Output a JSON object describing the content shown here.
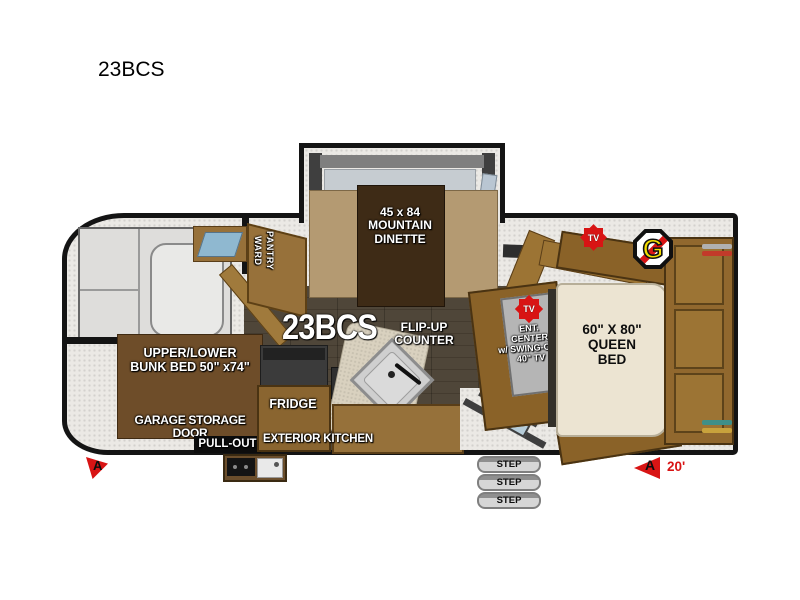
{
  "page": {
    "title": "23BCS"
  },
  "plan": {
    "model_large": "23BCS",
    "dinette": "45 x 84\nMOUNTAIN\nDINETTE",
    "ward_pantry": "WARD\nPANTRY",
    "flip_up_counter": "FLIP-UP\nCOUNTER",
    "ent_center": "ENT.\nCENTER\nw/ SWING-OUT\n40\" TV",
    "queen_bed": "60\" X 80\"\nQUEEN\nBED",
    "bunk_bed": "UPPER/LOWER\nBUNK BED 50\" x74\"",
    "garage_door": "GARAGE STORAGE DOOR",
    "pull_out": "PULL-OUT",
    "fridge": "FRIDGE",
    "exterior_kitchen": "EXTERIOR KITCHEN",
    "tv_badge": "TV",
    "brand_letter": "G",
    "marker_letter": "A",
    "length": "20'",
    "steps": [
      {
        "label": "STEP"
      },
      {
        "label": "STEP"
      },
      {
        "label": "STEP"
      }
    ],
    "colors": {
      "wall": "#141414",
      "cabinet_wood": "#97713a",
      "floor_wood": "#4b4136",
      "accent_red": "#d81414",
      "badge_yellow": "#f4dd00",
      "bed_cream": "#ece4d2",
      "counter_blue": "#8fb8d0"
    }
  }
}
